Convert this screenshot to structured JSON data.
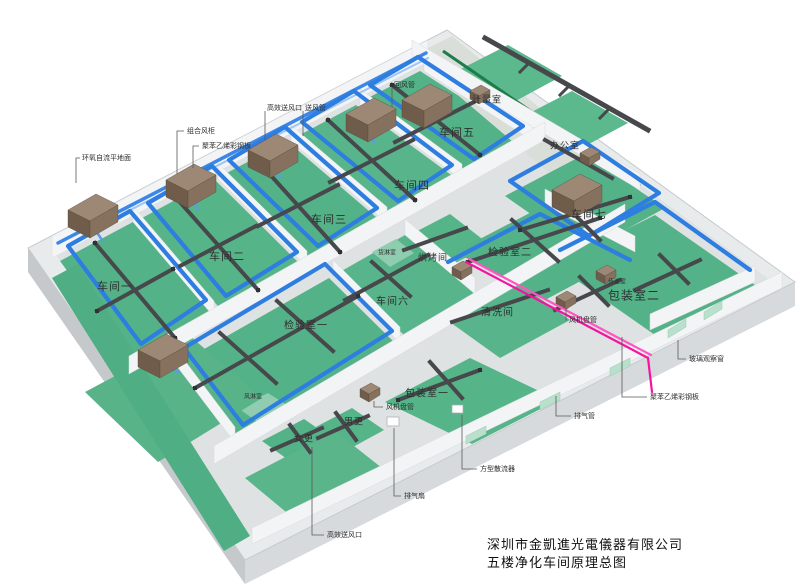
{
  "scene": {
    "type": "isometric-cleanroom-hvac-diagram",
    "description": "3D axonometric overview of a 5th-floor purification (cleanroom) workshop with HVAC ductwork"
  },
  "title": {
    "line1": "深圳市金凱進光電儀器有限公司",
    "line2": "五楼净化车间原理总图"
  },
  "colors": {
    "floor_green": "#53b287",
    "corridor_green": "#4fae83",
    "stripe_green": "#1e7c4b",
    "duct_blue": "#2e7de1",
    "duct_dark": "#46484b",
    "ahu_brown": "#8a7460",
    "exhaust_pink": "#f7129f",
    "wall_white": "#f2f4f6",
    "slab_gray": "#e8ebec",
    "background": "#ffffff"
  },
  "labels": [
    {
      "name": "label-epoxy-floor",
      "text": "环氧自流平地面",
      "x": 82,
      "y": 158,
      "s": 7
    },
    {
      "name": "label-combined-ahu",
      "text": "组合风柜",
      "x": 187,
      "y": 131,
      "s": 7
    },
    {
      "name": "label-polystyrene-panel-top",
      "text": "聚苯乙烯彩钢板",
      "x": 202,
      "y": 146,
      "s": 7
    },
    {
      "name": "label-hepa-outlet-top",
      "text": "高效送风口",
      "x": 267,
      "y": 108,
      "s": 7
    },
    {
      "name": "label-supply-duct",
      "text": "送风管",
      "x": 305,
      "y": 108,
      "s": 7
    },
    {
      "name": "label-return-duct",
      "text": "回风管",
      "x": 394,
      "y": 85,
      "s": 7
    },
    {
      "name": "label-fan-coil-right",
      "text": "风机盘管",
      "x": 569,
      "y": 320,
      "s": 7
    },
    {
      "name": "label-fan-coil-center",
      "text": "风机盘管",
      "x": 386,
      "y": 407,
      "s": 7
    },
    {
      "name": "label-exhaust-duct",
      "text": "排气管",
      "x": 574,
      "y": 416,
      "s": 7
    },
    {
      "name": "label-glass-window",
      "text": "玻璃观察窗",
      "x": 689,
      "y": 359,
      "s": 7
    },
    {
      "name": "label-polystyrene-panel-right",
      "text": "聚苯乙烯彩钢板",
      "x": 650,
      "y": 397,
      "s": 7
    },
    {
      "name": "label-square-diffuser",
      "text": "方型散流器",
      "x": 480,
      "y": 469,
      "s": 7
    },
    {
      "name": "label-exhaust-fan",
      "text": "排气扇",
      "x": 404,
      "y": 496,
      "s": 7
    },
    {
      "name": "label-hepa-outlet-bottom",
      "text": "高效送风口",
      "x": 327,
      "y": 535,
      "s": 7
    },
    {
      "name": "label-transfer-room",
      "text": "传递室",
      "x": 608,
      "y": 281,
      "s": 6
    },
    {
      "name": "label-cargo-shower",
      "text": "货淋室",
      "x": 378,
      "y": 252,
      "s": 6
    },
    {
      "name": "label-air-shower",
      "text": "风淋室",
      "x": 244,
      "y": 396,
      "s": 6
    },
    {
      "name": "label-workshop-1",
      "text": "车间一",
      "x": 97,
      "y": 286,
      "s": 11
    },
    {
      "name": "label-workshop-2",
      "text": "车间二",
      "x": 209,
      "y": 256,
      "s": 11
    },
    {
      "name": "label-workshop-3",
      "text": "车间三",
      "x": 311,
      "y": 219,
      "s": 11
    },
    {
      "name": "label-workshop-4",
      "text": "车间四",
      "x": 394,
      "y": 185,
      "s": 11
    },
    {
      "name": "label-workshop-5",
      "text": "车间五",
      "x": 439,
      "y": 132,
      "s": 11
    },
    {
      "name": "label-workshop-6",
      "text": "车间六",
      "x": 376,
      "y": 300,
      "s": 10
    },
    {
      "name": "label-workshop-7",
      "text": "车间七",
      "x": 571,
      "y": 214,
      "s": 11
    },
    {
      "name": "label-inspection-room-1",
      "text": "检验室一",
      "x": 284,
      "y": 324,
      "s": 10
    },
    {
      "name": "label-inspection-room-2",
      "text": "检验室二",
      "x": 488,
      "y": 251,
      "s": 10
    },
    {
      "name": "label-cleaning-room",
      "text": "清洗间",
      "x": 481,
      "y": 311,
      "s": 10
    },
    {
      "name": "label-baking-room",
      "text": "烘烤间",
      "x": 418,
      "y": 257,
      "s": 9
    },
    {
      "name": "label-packing-room-1",
      "text": "包装室一",
      "x": 405,
      "y": 392,
      "s": 10
    },
    {
      "name": "label-packing-room-2",
      "text": "包装室二",
      "x": 608,
      "y": 295,
      "s": 12
    },
    {
      "name": "label-office",
      "text": "办公室",
      "x": 550,
      "y": 145,
      "s": 9
    },
    {
      "name": "label-metering-room",
      "text": "计量室",
      "x": 472,
      "y": 99,
      "s": 9
    },
    {
      "name": "label-women-changing",
      "text": "女更",
      "x": 294,
      "y": 438,
      "s": 9
    },
    {
      "name": "label-men-changing",
      "text": "男更",
      "x": 344,
      "y": 421,
      "s": 9
    }
  ]
}
